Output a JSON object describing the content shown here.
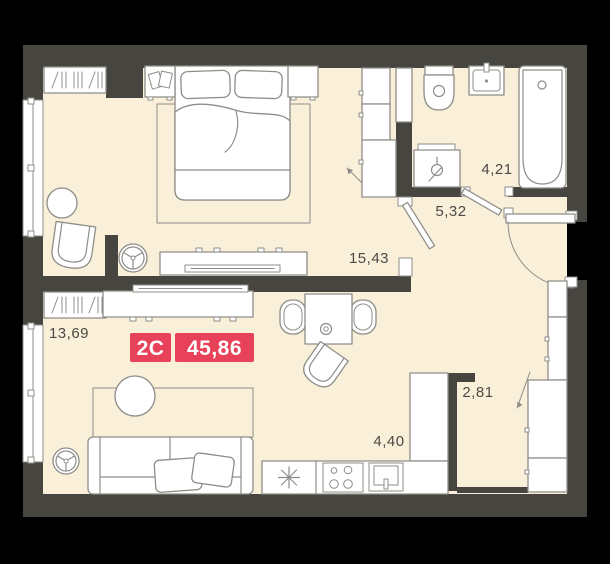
{
  "plan": {
    "type_badge": "2С",
    "total_area_badge": "45,86"
  },
  "rooms": {
    "bedroom": {
      "area": "15,43"
    },
    "living": {
      "area": "13,69"
    },
    "hall": {
      "area": "5,32"
    },
    "bathroom": {
      "area": "4,21"
    },
    "corridor": {
      "area": "2,81"
    },
    "kitchen": {
      "area": "4,40"
    }
  },
  "icons": {
    "fridge": "snowflake-asterisk",
    "stove": "four-burners",
    "kitchen_sink": "basin-with-tap",
    "washing_machine": "tap-valve",
    "bath_sink": "basin-with-tap",
    "toilet": "bowl-with-cistern",
    "bathtub": "tub-with-drain",
    "ventilation": "three-spoke-fan",
    "wardrobe_hatch": "slash-bars",
    "door": "leaf-with-swing-arc"
  },
  "colors": {
    "background": "#000000",
    "floor": "#faf0da",
    "wall": "#47453f",
    "furniture_fill": "#ffffff",
    "furniture_outline": "#8e8d89",
    "accent": "#e8415a",
    "label_text": "#4b4a45",
    "badge_text": "#ffffff"
  }
}
